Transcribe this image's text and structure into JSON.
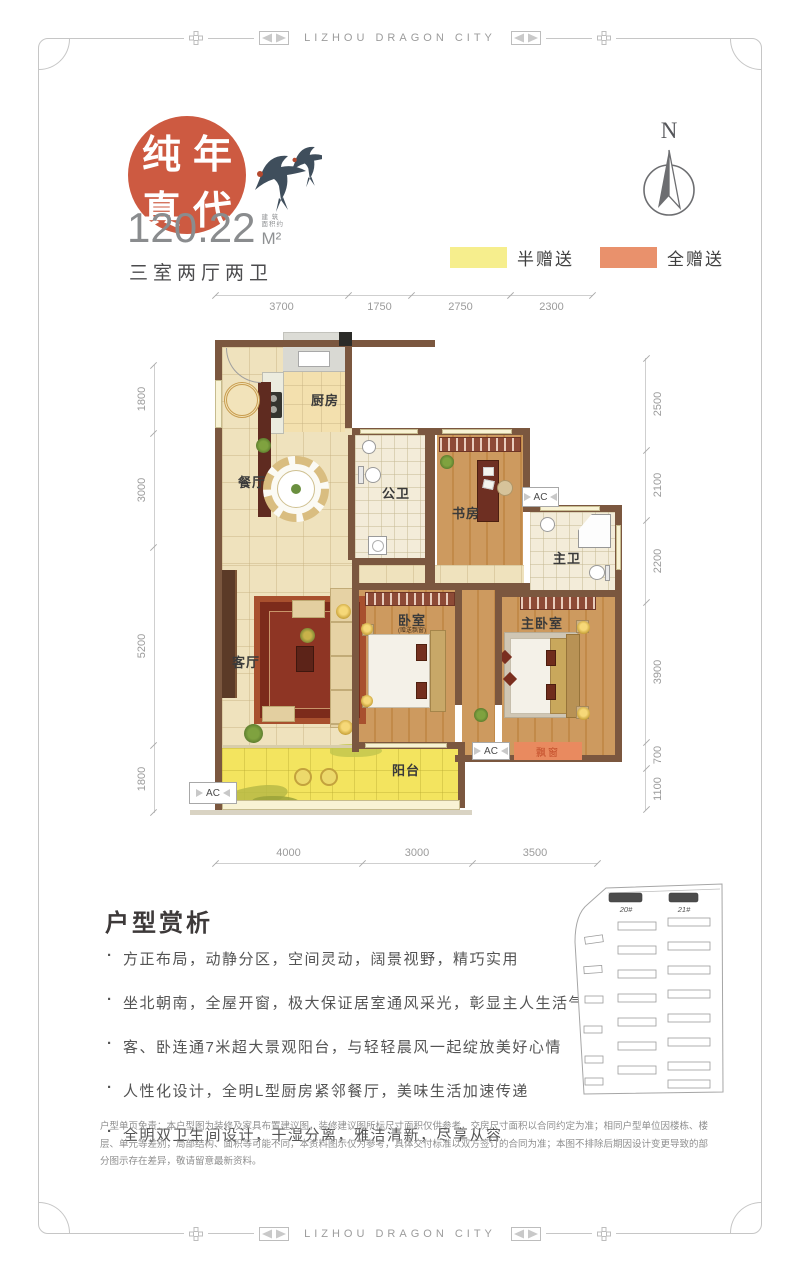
{
  "frame": {
    "brand": "LIZHOU DRAGON CITY"
  },
  "header": {
    "seal_chars": [
      "纯",
      "年",
      "真",
      "代"
    ],
    "area_value": "120.22",
    "area_note_line1": "建 筑",
    "area_note_line2": "面积约",
    "area_unit": "M²",
    "layout_type": "三室两厅两卫",
    "compass_label": "N"
  },
  "legend": {
    "half_gift": {
      "label": "半赠送",
      "color": "#f6ee8d"
    },
    "full_gift": {
      "label": "全赠送",
      "color": "#e9916c"
    }
  },
  "plan": {
    "dims": {
      "top": [
        "3700",
        "1750",
        "2750",
        "2300"
      ],
      "bottom": [
        "4000",
        "3000",
        "3500"
      ],
      "left": [
        "1800",
        "3000",
        "5200",
        "1800"
      ],
      "right": [
        "2500",
        "2100",
        "2200",
        "3900",
        "700",
        "1100"
      ]
    },
    "rooms": {
      "kitchen": "厨房",
      "dining": "餐厅",
      "public_bath": "公卫",
      "study": "书房",
      "master_bath": "主卫",
      "living": "客厅",
      "bedroom": "卧室",
      "bedroom_note": "(赠送飘窗)",
      "master_bedroom": "主卧室",
      "balcony": "阳台",
      "bay_window": "飘窗",
      "ac": "AC"
    }
  },
  "analysis": {
    "title": "户型赏析",
    "bullets": [
      "方正布局，动静分区，空间灵动，阔景视野，精巧实用",
      "坐北朝南，全屋开窗，极大保证居室通风采光，彰显主人生活气度",
      "客、卧连通7米超大景观阳台，与轻轻晨风一起绽放美好心情",
      "人性化设计，全明L型厨房紧邻餐厅，美味生活加速传递",
      "全明双卫生间设计，干湿分离，雅洁清新，尽享从容"
    ]
  },
  "siteplan": {
    "buildings": [
      "20#",
      "21#"
    ]
  },
  "disclaimer": "户型单页免责：本户型图为装修及家具布置建议图，装修建议图所标尺寸面积仅供参考，交房尺寸面积以合同约定为准；相同户型单位因楼栋、楼层、单元等差别，局部结构、面积等可能不同，本资料图示仅为参考，具体交付标准以双方签订的合同为准；本图不排除后期因设计变更导致的部分图示存在差异，敬请留意最新资料。",
  "colors": {
    "seal": "#cd5a41",
    "legend_half": "#f6ee8d",
    "legend_full": "#e9916c",
    "wall": "#7b573f",
    "balcony_fill": "#f3e45f",
    "bay_window_fill": "#e98a5f"
  }
}
